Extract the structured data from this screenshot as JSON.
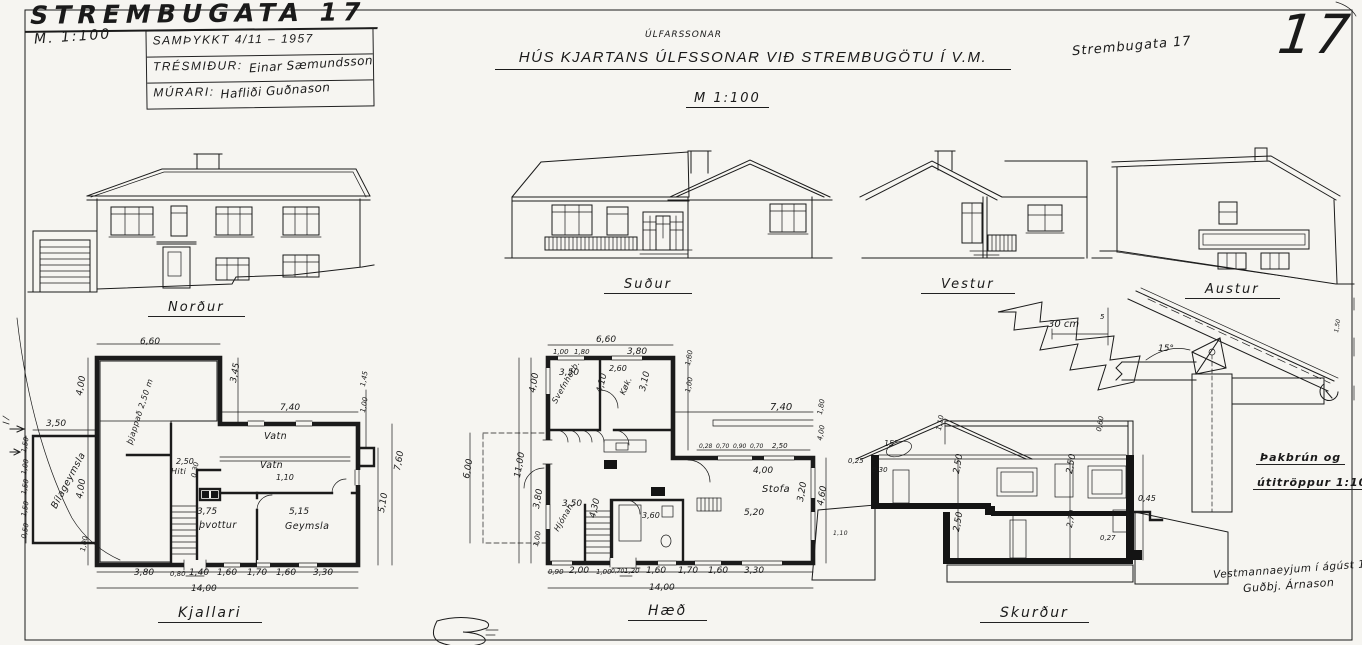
{
  "sheet": {
    "title": "STREMBUGATA 17",
    "scale_note": "M. 1:100",
    "sheet_number": "17",
    "corner_note": "Strembugata 17",
    "approval": {
      "line1": "SAMÞYKKT 4/11 – 1957",
      "carpenter_label": "TRÉSMIÐUR:",
      "carpenter_signature": "Einar Sæmundsson",
      "mason_label": "MÚRARI:",
      "mason_signature": "Hafliði Guðnason"
    },
    "main_title": "HÚS KJARTANS ÚLFSSONAR VIÐ STREMBUGÖTU Í V.M.",
    "main_title_correction": "ÚLFARSSONAR",
    "main_scale": "M 1:100"
  },
  "elevations": {
    "north": "Norður",
    "south": "Suður",
    "west": "Vestur",
    "east": "Austur"
  },
  "plans": {
    "basement": "Kjallari",
    "main_floor": "Hæð",
    "section": "Skurður"
  },
  "detail": {
    "line1": "Þakbrún og",
    "line2": "útitröppur 1:10"
  },
  "signature": {
    "place_date": "Vestmannaeyjum í ágúst 1957",
    "name": "Guðbj. Árnason"
  },
  "annotations": [
    {
      "x": 140,
      "y": 338,
      "t": "6,60"
    },
    {
      "x": 46,
      "y": 420,
      "t": "3,50"
    },
    {
      "x": 76,
      "y": 395,
      "t": "4,00",
      "r": -80
    },
    {
      "x": 76,
      "y": 498,
      "t": "4,00",
      "r": -80
    },
    {
      "x": 80,
      "y": 551,
      "t": "1,00",
      "r": -80,
      "s": 7
    },
    {
      "x": 21,
      "y": 452,
      "t": "1,50",
      "r": -80,
      "s": 7
    },
    {
      "x": 21,
      "y": 474,
      "t": "1,00",
      "r": -80,
      "s": 7
    },
    {
      "x": 21,
      "y": 494,
      "t": "1,50",
      "r": -80,
      "s": 7
    },
    {
      "x": 21,
      "y": 516,
      "t": "1,50",
      "r": -80,
      "s": 7
    },
    {
      "x": 21,
      "y": 538,
      "t": "0,50",
      "r": -80,
      "s": 7
    },
    {
      "x": 230,
      "y": 382,
      "t": "3,45",
      "r": -80
    },
    {
      "x": 280,
      "y": 404,
      "t": "7,40"
    },
    {
      "x": 360,
      "y": 386,
      "t": "1,45",
      "r": -80,
      "s": 7
    },
    {
      "x": 360,
      "y": 412,
      "t": "1,00",
      "r": -80,
      "s": 7
    },
    {
      "x": 394,
      "y": 470,
      "t": "7,60",
      "r": -80
    },
    {
      "x": 378,
      "y": 512,
      "t": "5,10",
      "r": -80
    },
    {
      "x": 176,
      "y": 458,
      "t": "2,50",
      "s": 8
    },
    {
      "x": 171,
      "y": 468,
      "t": "Hiti",
      "c": "scrib",
      "s": 8
    },
    {
      "x": 191,
      "y": 477,
      "t": "0,30",
      "r": -80,
      "s": 7
    },
    {
      "x": 264,
      "y": 432,
      "t": "Vatn",
      "c": "scrib"
    },
    {
      "x": 260,
      "y": 461,
      "t": "Vatn",
      "c": "scrib"
    },
    {
      "x": 276,
      "y": 474,
      "t": "1,10",
      "s": 8
    },
    {
      "x": 197,
      "y": 508,
      "t": "3,75"
    },
    {
      "x": 199,
      "y": 521,
      "t": "þvottur",
      "c": "scrib"
    },
    {
      "x": 289,
      "y": 508,
      "t": "5,15"
    },
    {
      "x": 285,
      "y": 522,
      "t": "Geymsla",
      "c": "scrib"
    },
    {
      "x": 50,
      "y": 506,
      "t": "Bílageymsla",
      "r": -62,
      "c": "scrib"
    },
    {
      "x": 126,
      "y": 443,
      "t": "þjappað 2,50 m",
      "r": -72,
      "c": "scrib",
      "s": 8
    },
    {
      "x": 134,
      "y": 569,
      "t": "3,80"
    },
    {
      "x": 170,
      "y": 571,
      "t": "0,80",
      "s": 7
    },
    {
      "x": 189,
      "y": 569,
      "t": "1,40"
    },
    {
      "x": 217,
      "y": 569,
      "t": "1,60"
    },
    {
      "x": 247,
      "y": 569,
      "t": "1,70"
    },
    {
      "x": 276,
      "y": 569,
      "t": "1,60"
    },
    {
      "x": 313,
      "y": 569,
      "t": "3,30"
    },
    {
      "x": 191,
      "y": 585,
      "t": "14,00"
    },
    {
      "x": 596,
      "y": 336,
      "t": "6,60"
    },
    {
      "x": 553,
      "y": 349,
      "t": "1,00",
      "s": 7
    },
    {
      "x": 574,
      "y": 349,
      "t": "1,80",
      "s": 7
    },
    {
      "x": 627,
      "y": 348,
      "t": "3,80"
    },
    {
      "x": 685,
      "y": 365,
      "t": "1,80",
      "r": -80,
      "s": 7
    },
    {
      "x": 685,
      "y": 392,
      "t": "1,00",
      "r": -80,
      "s": 7
    },
    {
      "x": 770,
      "y": 403,
      "t": "7,40",
      "s": 10
    },
    {
      "x": 529,
      "y": 392,
      "t": "4,00",
      "r": -80
    },
    {
      "x": 514,
      "y": 477,
      "t": "11,00",
      "r": -80
    },
    {
      "x": 533,
      "y": 508,
      "t": "3,80",
      "r": -80
    },
    {
      "x": 533,
      "y": 546,
      "t": "1,00",
      "r": -80,
      "s": 7
    },
    {
      "x": 463,
      "y": 478,
      "t": "6,00",
      "r": -80
    },
    {
      "x": 559,
      "y": 369,
      "t": "3,50"
    },
    {
      "x": 551,
      "y": 401,
      "t": "Svefnherb.",
      "r": -60,
      "c": "scrib",
      "s": 8
    },
    {
      "x": 596,
      "y": 392,
      "t": "4,10",
      "r": -76
    },
    {
      "x": 619,
      "y": 393,
      "t": "Køk.",
      "r": -66,
      "c": "scrib",
      "s": 8
    },
    {
      "x": 639,
      "y": 390,
      "t": "3,10",
      "r": -76
    },
    {
      "x": 609,
      "y": 365,
      "t": "2,60",
      "s": 8
    },
    {
      "x": 699,
      "y": 444,
      "t": "0,28",
      "s": 6
    },
    {
      "x": 716,
      "y": 444,
      "t": "0,70",
      "s": 6
    },
    {
      "x": 733,
      "y": 444,
      "t": "0,90",
      "s": 6
    },
    {
      "x": 750,
      "y": 444,
      "t": "0,70",
      "s": 6
    },
    {
      "x": 772,
      "y": 443,
      "t": "2,50",
      "s": 7
    },
    {
      "x": 753,
      "y": 467,
      "t": "4,00"
    },
    {
      "x": 744,
      "y": 509,
      "t": "5,20"
    },
    {
      "x": 762,
      "y": 485,
      "t": "Stofa",
      "c": "scrib",
      "s": 10
    },
    {
      "x": 642,
      "y": 512,
      "t": "3,60",
      "s": 8
    },
    {
      "x": 797,
      "y": 501,
      "t": "3,20",
      "r": -80
    },
    {
      "x": 817,
      "y": 505,
      "t": "4,60",
      "r": -80
    },
    {
      "x": 817,
      "y": 440,
      "t": "4,00",
      "r": -80,
      "s": 7
    },
    {
      "x": 817,
      "y": 414,
      "t": "1,80",
      "r": -80,
      "s": 7
    },
    {
      "x": 562,
      "y": 500,
      "t": "3,50"
    },
    {
      "x": 553,
      "y": 529,
      "t": "Hjónah.",
      "r": -60,
      "c": "scrib",
      "s": 8
    },
    {
      "x": 589,
      "y": 517,
      "t": "4,30",
      "r": -76
    },
    {
      "x": 548,
      "y": 569,
      "t": "0,90",
      "s": 7
    },
    {
      "x": 569,
      "y": 567,
      "t": "2,00"
    },
    {
      "x": 596,
      "y": 569,
      "t": "1,00",
      "s": 7
    },
    {
      "x": 611,
      "y": 569,
      "t": "0,70",
      "s": 6
    },
    {
      "x": 624,
      "y": 568,
      "t": "1,20",
      "s": 7
    },
    {
      "x": 646,
      "y": 567,
      "t": "1,60"
    },
    {
      "x": 678,
      "y": 567,
      "t": "1,70"
    },
    {
      "x": 708,
      "y": 567,
      "t": "1,60"
    },
    {
      "x": 744,
      "y": 567,
      "t": "3,30"
    },
    {
      "x": 649,
      "y": 584,
      "t": "14,00"
    },
    {
      "x": 833,
      "y": 531,
      "t": "1,10",
      "s": 6,
      "c": "scrib"
    },
    {
      "x": 884,
      "y": 440,
      "t": "15°",
      "s": 8
    },
    {
      "x": 936,
      "y": 430,
      "t": "1,10",
      "r": -80,
      "s": 7
    },
    {
      "x": 848,
      "y": 458,
      "t": "0,25",
      "s": 7
    },
    {
      "x": 872,
      "y": 467,
      "t": "0,30",
      "s": 7
    },
    {
      "x": 953,
      "y": 473,
      "t": "2,50",
      "r": -80
    },
    {
      "x": 953,
      "y": 531,
      "t": "2,50",
      "r": -80
    },
    {
      "x": 1066,
      "y": 473,
      "t": "2,50",
      "r": -80
    },
    {
      "x": 1066,
      "y": 527,
      "t": "2,70",
      "r": -80,
      "s": 8
    },
    {
      "x": 1096,
      "y": 431,
      "t": "0,60",
      "r": -80,
      "s": 7
    },
    {
      "x": 1138,
      "y": 495,
      "t": "0,45",
      "s": 8
    },
    {
      "x": 1100,
      "y": 535,
      "t": "0,27",
      "s": 7
    },
    {
      "x": 1048,
      "y": 320,
      "t": "30 cm",
      "s": 10
    },
    {
      "x": 1158,
      "y": 345,
      "t": "15°",
      "s": 9
    },
    {
      "x": 1334,
      "y": 332,
      "t": "1,50",
      "r": -80,
      "s": 6
    },
    {
      "x": 1100,
      "y": 314,
      "t": "5",
      "s": 7
    }
  ]
}
